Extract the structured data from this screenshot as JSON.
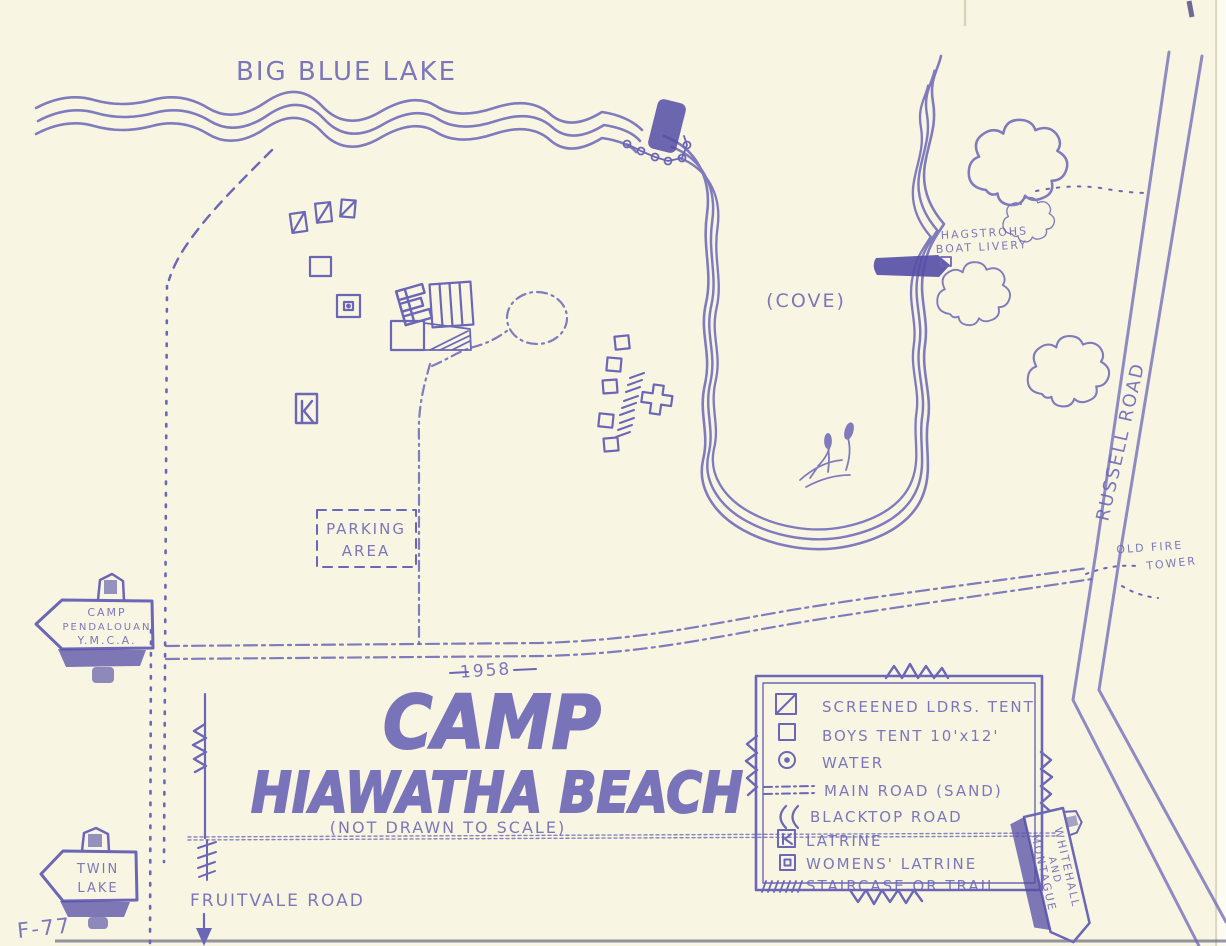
{
  "colors": {
    "paper": "#f8f6e3",
    "ink": "#6c66b6",
    "ink_dark": "#544ea6"
  },
  "map": {
    "lake_name": "BIG BLUE LAKE",
    "cove_label": "(COVE)",
    "boat_livery": {
      "line1": "HAGSTROHS",
      "line2": "BOAT LIVERY"
    },
    "roads": {
      "russell": "RUSSELL ROAD",
      "fruitvale": "FRUITVALE ROAD"
    },
    "fire_tower": {
      "line1": "OLD FIRE",
      "line2": "TOWER"
    },
    "parking": {
      "line1": "PARKING",
      "line2": "AREA"
    },
    "signs": {
      "camp_pendalouan": {
        "line1": "CAMP",
        "line2": "PENDALOUAN",
        "line3": "Y.M.C.A."
      },
      "twin_lake": {
        "line1": "TWIN",
        "line2": "LAKE"
      },
      "whitehall": {
        "line1": "WHITEHALL",
        "line2": "AND",
        "line3": "MONTAGUE"
      }
    },
    "title": {
      "year": "1958",
      "line1": "CAMP",
      "line2": "HIAWATHA BEACH",
      "note": "(NOT DRAWN TO SCALE)"
    },
    "plate_number": "F-77"
  },
  "legend": {
    "items": [
      {
        "symbol": "screened-tent",
        "label": "SCREENED LDRS. TENT"
      },
      {
        "symbol": "boys-tent",
        "label": "BOYS TENT  10'x12'"
      },
      {
        "symbol": "water",
        "label": "WATER"
      },
      {
        "symbol": "main-road-sand",
        "label": "MAIN ROAD (SAND)"
      },
      {
        "symbol": "blacktop-road",
        "label": "BLACKTOP ROAD"
      },
      {
        "symbol": "latrine",
        "label": "LATRINE"
      },
      {
        "symbol": "womens-latrine",
        "label": "WOMENS' LATRINE"
      },
      {
        "symbol": "staircase-trail",
        "label": "STAIRCASE OR TRAIL"
      }
    ]
  }
}
